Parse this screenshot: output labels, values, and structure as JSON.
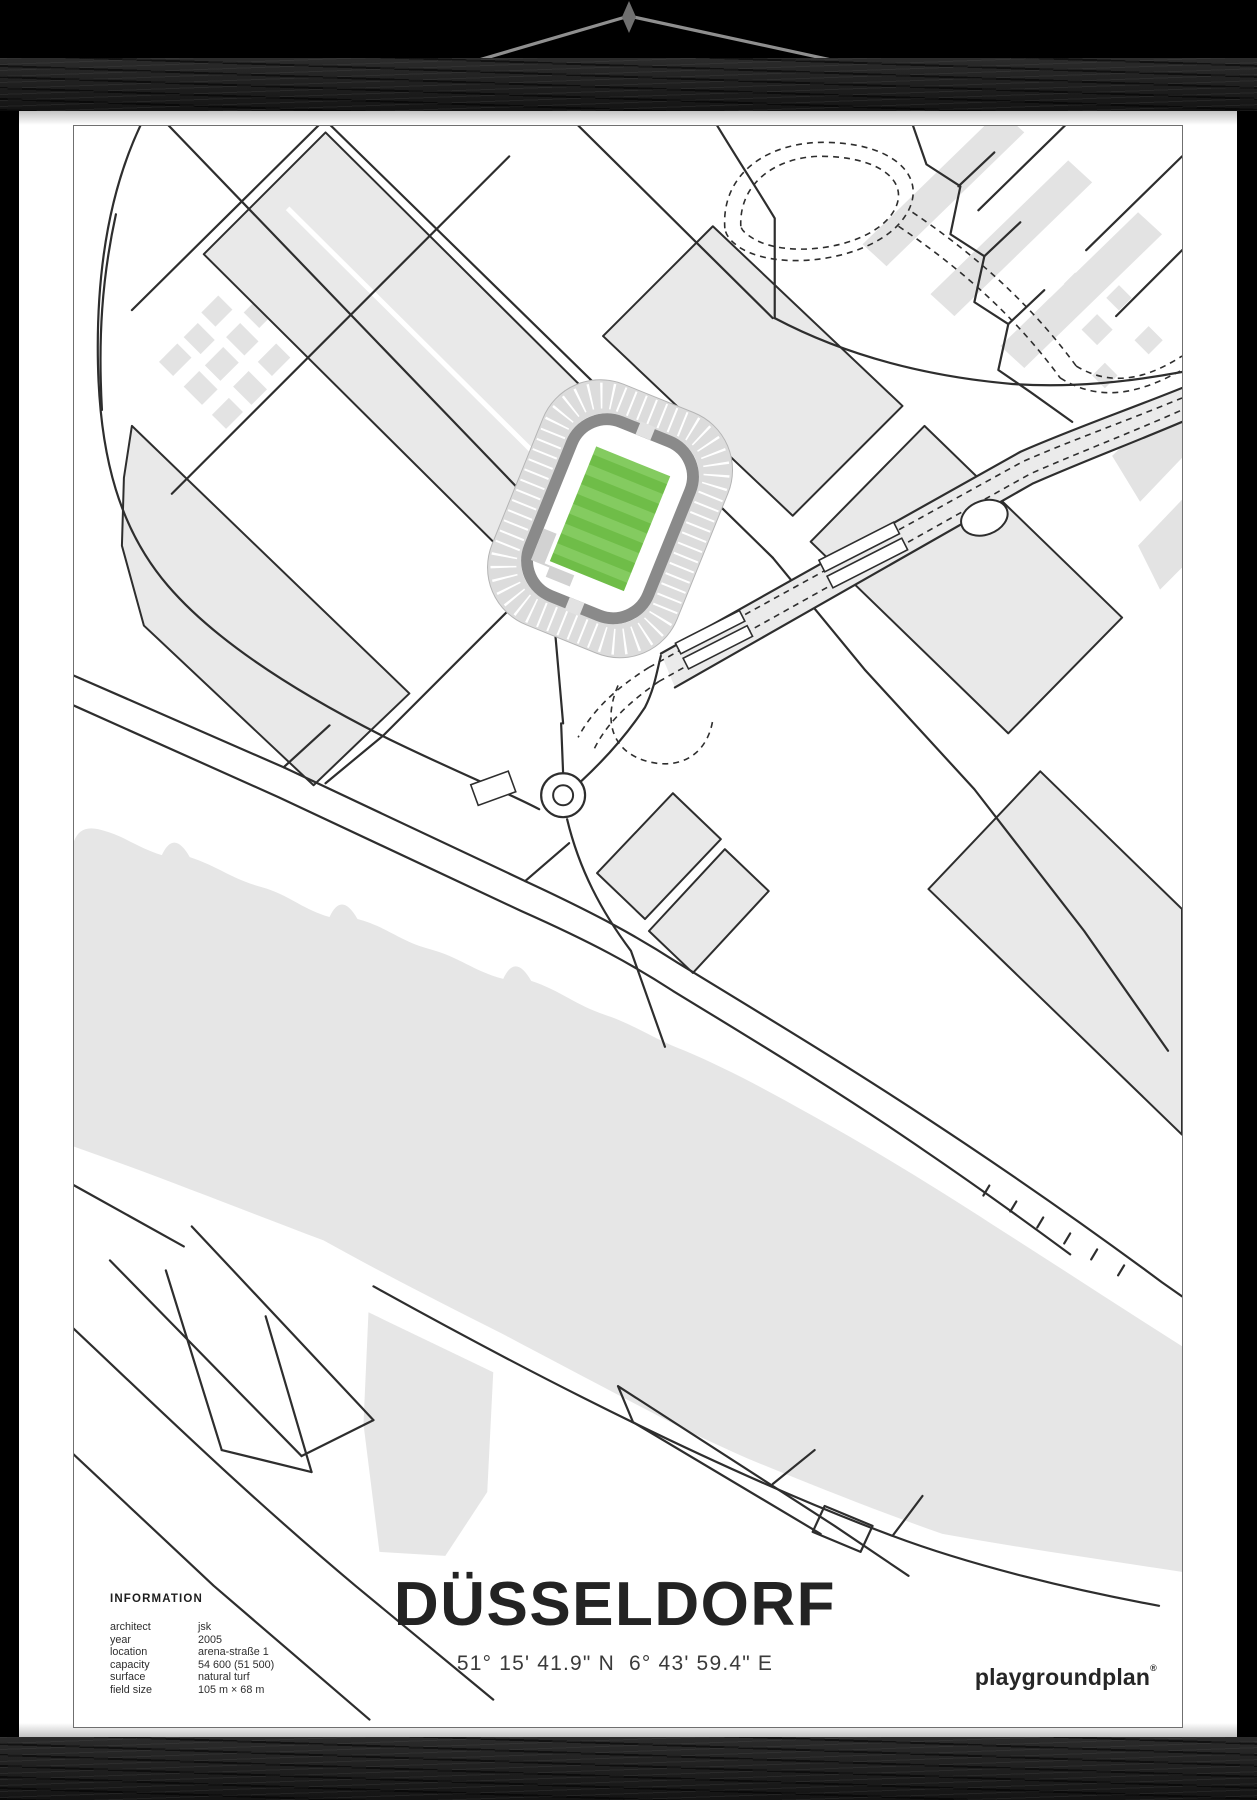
{
  "poster": {
    "title": "DÜSSELDORF",
    "coordinates": "51° 15' 41.9\" N  6° 43' 59.4\" E",
    "brand": "playgroundplan",
    "brand_mark": "®"
  },
  "information": {
    "heading": "INFORMATION",
    "rows": [
      {
        "label": "architect",
        "value": "jsk"
      },
      {
        "label": "year",
        "value": "2005"
      },
      {
        "label": "location",
        "value": "arena-straße 1"
      },
      {
        "label": "capacity",
        "value": "54 600 (51 500)"
      },
      {
        "label": "surface",
        "value": "natural turf"
      },
      {
        "label": "field size",
        "value": "105 m × 68 m"
      }
    ]
  },
  "map": {
    "colors": {
      "land_grey": "#e6e6e6",
      "building_grey": "#e9e9e9",
      "soft_grey": "#e3e3e3",
      "road": "#2e2e2e",
      "stand_grey": "#dcdcdc",
      "concourse_grey": "#8a8a8a",
      "pitch_green": "#6fbd48",
      "pitch_stripe": "#84cb60",
      "frame_border": "#6f6f6f"
    }
  },
  "hardware": {
    "rail_color": "#1b1b1b",
    "cord_color": "#8f8f8f",
    "background": "#000000"
  }
}
